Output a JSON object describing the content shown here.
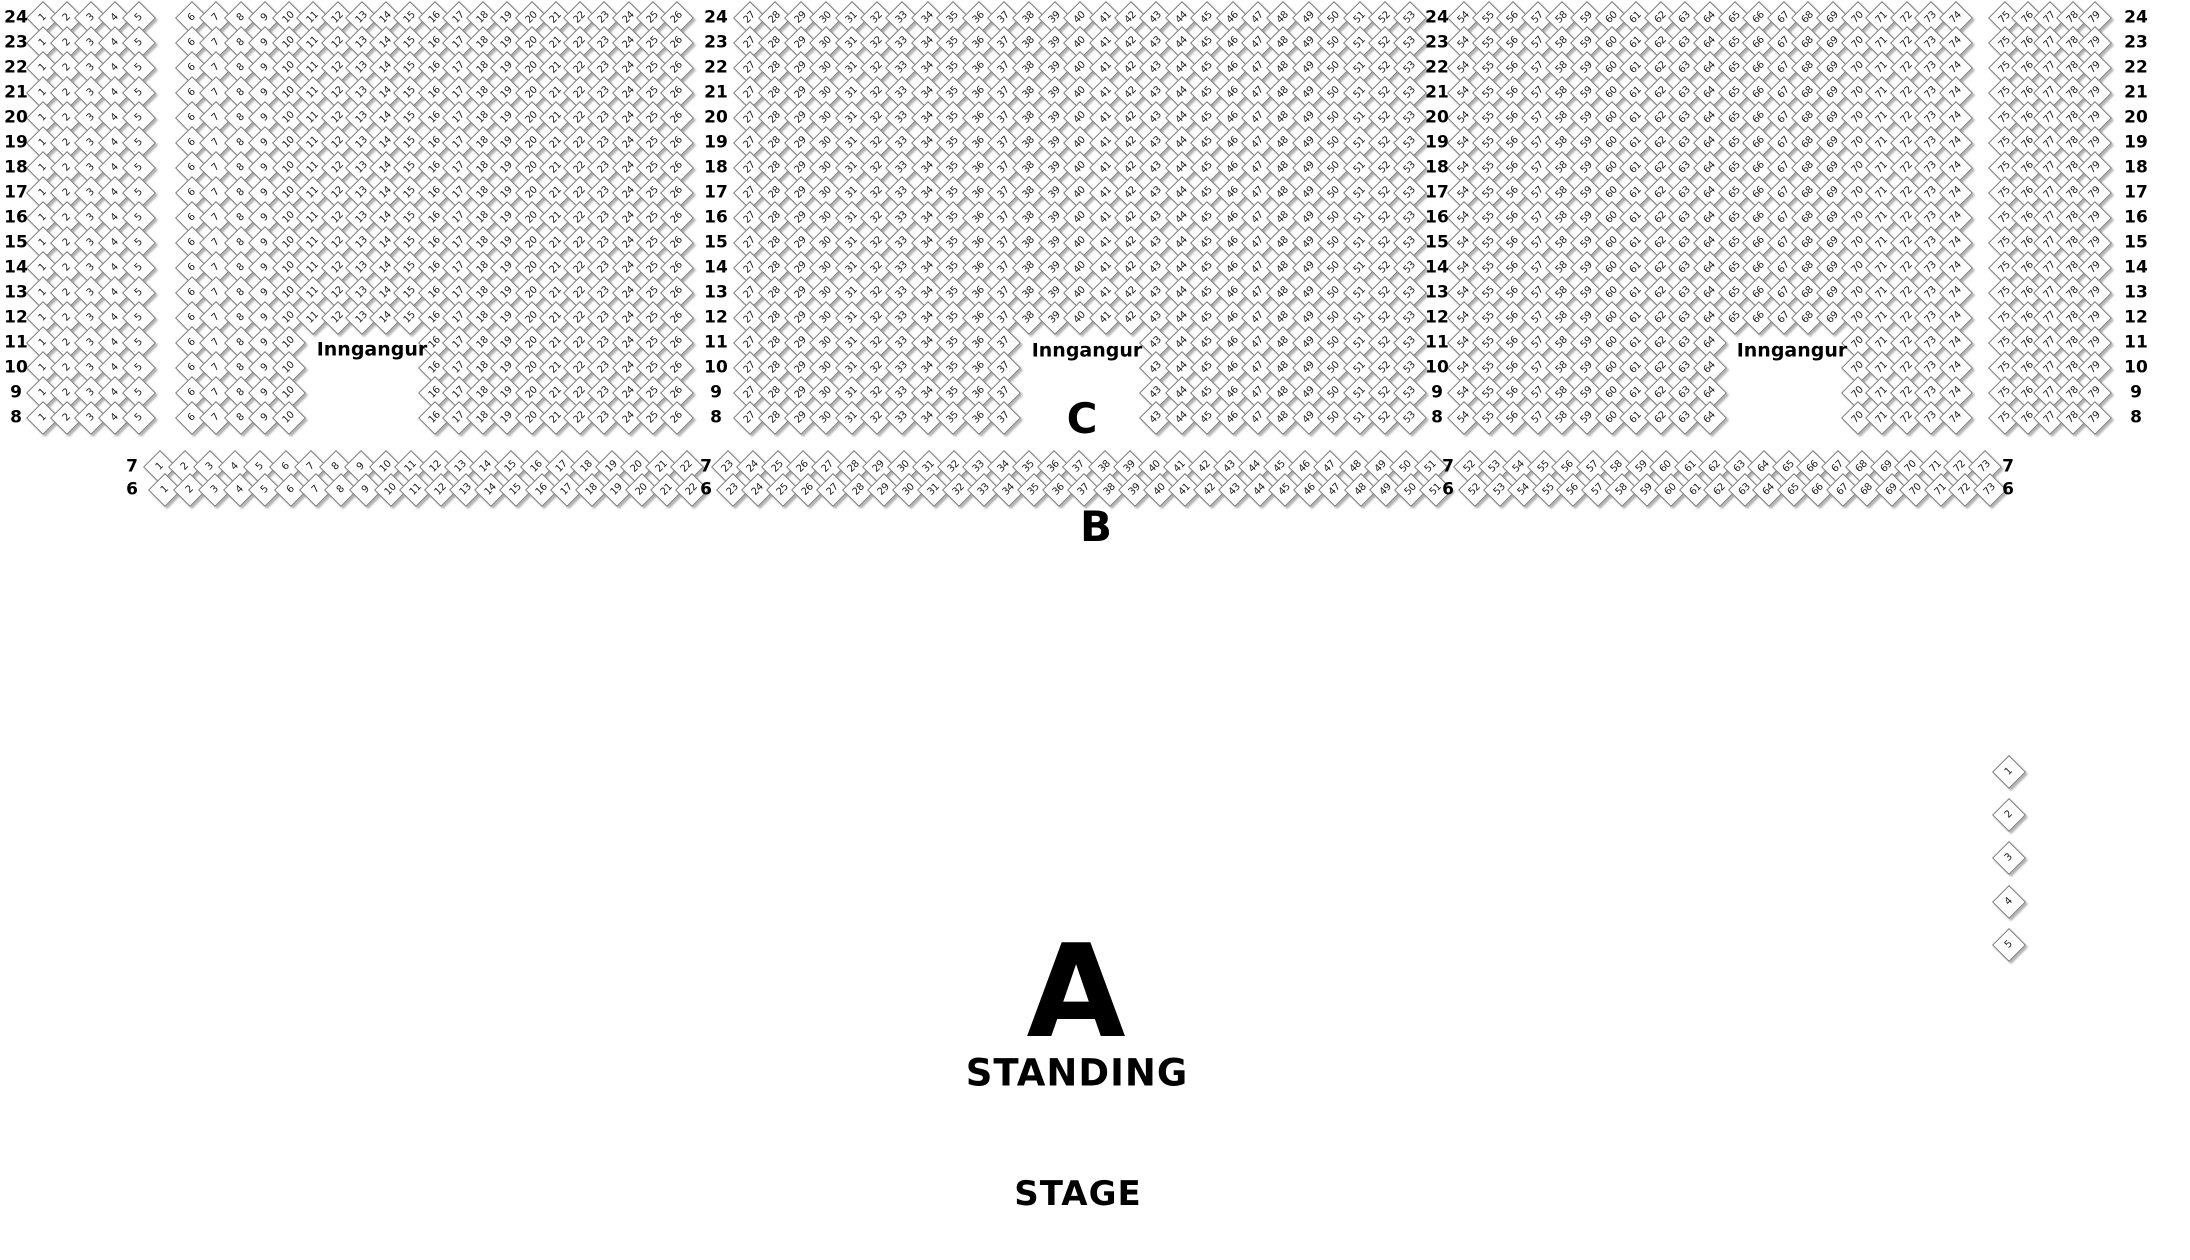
{
  "venue_map": {
    "colors": {
      "background": "#ffffff",
      "seat_fill": "#ffffff",
      "seat_border": "#7d7d7d",
      "text": "#000000"
    },
    "section_c": {
      "label": "C",
      "label_x": 1082,
      "label_y": 419,
      "rows_from": 24,
      "rows_to": 8,
      "row_y_start": 18,
      "row_pitch": 25,
      "row_label_columns_x": [
        16,
        716,
        1437,
        2136
      ],
      "entrance_rows_from": 11,
      "entrance_rows_to": 8,
      "blocks": [
        {
          "seat_from": 1,
          "seat_to": 5,
          "x_start": 43,
          "pitch": 24
        },
        {
          "seat_from": 6,
          "seat_to": 26,
          "x_start": 192,
          "pitch": 24.25,
          "entrance_skip_from": 11,
          "entrance_skip_to": 15
        },
        {
          "seat_from": 27,
          "seat_to": 53,
          "x_start": 750,
          "pitch": 25.4,
          "entrance_skip_from": 38,
          "entrance_skip_to": 42
        },
        {
          "seat_from": 54,
          "seat_to": 74,
          "x_start": 1464,
          "pitch": 24.6,
          "entrance_skip_from": 65,
          "entrance_skip_to": 69
        },
        {
          "seat_from": 75,
          "seat_to": 79,
          "x_start": 2005,
          "pitch": 22.5
        }
      ]
    },
    "section_b": {
      "label": "B",
      "label_x": 1096,
      "label_y": 527,
      "rows": [
        {
          "number": 7,
          "y": 467,
          "dx": 0
        },
        {
          "number": 6,
          "y": 490,
          "dx": 5
        }
      ],
      "row_label_columns_x": [
        132,
        706,
        1448,
        2008
      ],
      "segments": [
        {
          "seat_from": 1,
          "seat_to": 22,
          "x_start": 160,
          "pitch": 25.1
        },
        {
          "seat_from": 23,
          "seat_to": 51,
          "x_start": 728,
          "pitch": 25.1
        },
        {
          "seat_from": 52,
          "seat_to": 73,
          "x_start": 1470,
          "pitch": 24.5
        }
      ]
    },
    "entrances": [
      {
        "label": "Inngangur",
        "x": 372,
        "y": 350
      },
      {
        "label": "Inngangur",
        "x": 1087,
        "y": 351
      },
      {
        "label": "Inngangur",
        "x": 1792,
        "y": 351
      }
    ],
    "standing_section": {
      "letter": "A",
      "letter_x": 1076,
      "letter_y": 993,
      "label": "STANDING",
      "label_x": 1077,
      "label_y": 1073
    },
    "stage": {
      "label": "STAGE",
      "x": 1078,
      "y": 1194
    },
    "side_seats": {
      "seat_from": 1,
      "seat_to": 5,
      "x": 2009,
      "y_start": 772,
      "pitch": 43.2
    }
  }
}
